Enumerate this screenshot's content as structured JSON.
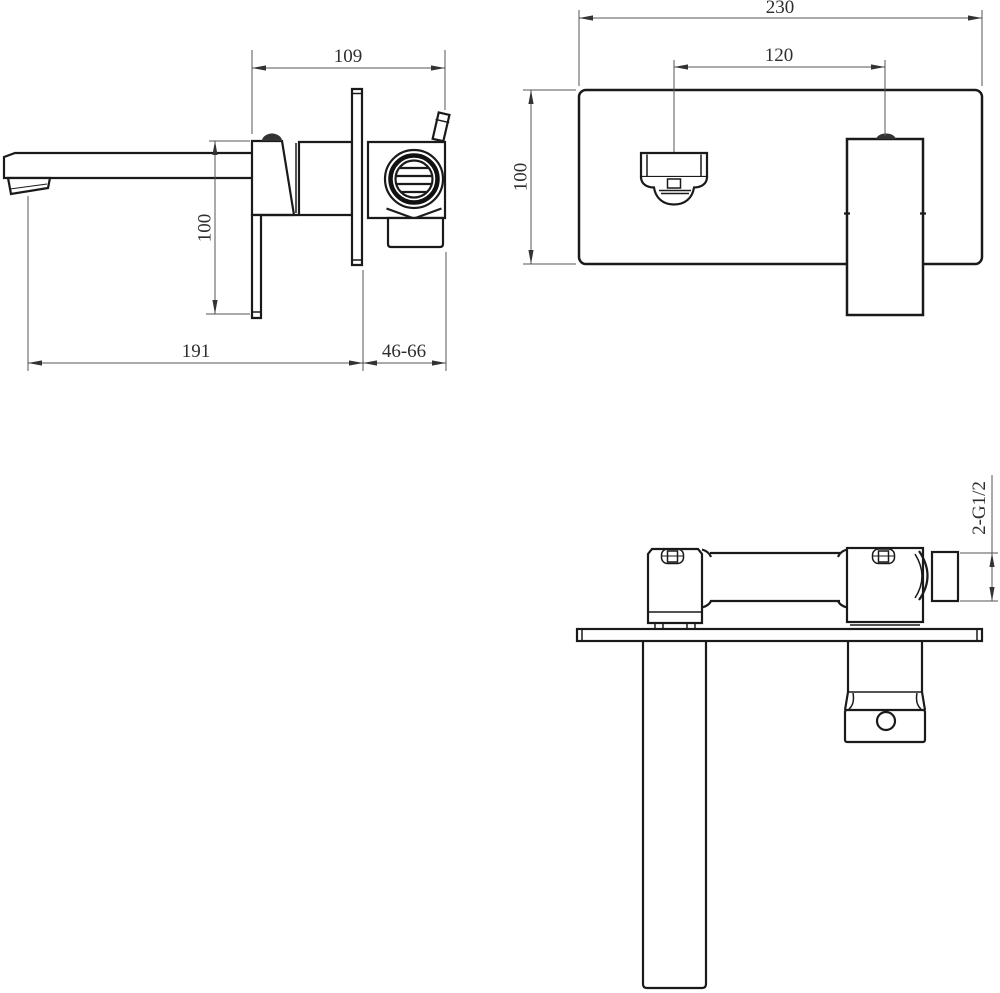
{
  "colors": {
    "outline": "#1a1a1a",
    "dimension_line": "#565656",
    "text": "#2e2e2e",
    "background": "#ffffff",
    "filled_detail": "#111111"
  },
  "views": {
    "side": {
      "dims": {
        "body_depth": "109",
        "handle_drop": "100",
        "spout_reach": "191",
        "wall_range": "46-66"
      }
    },
    "front": {
      "dims": {
        "plate_width": "230",
        "center_distance": "120",
        "plate_height": "100"
      }
    },
    "top": {
      "dims": {
        "thread_spec": "2-G1/2"
      }
    }
  }
}
